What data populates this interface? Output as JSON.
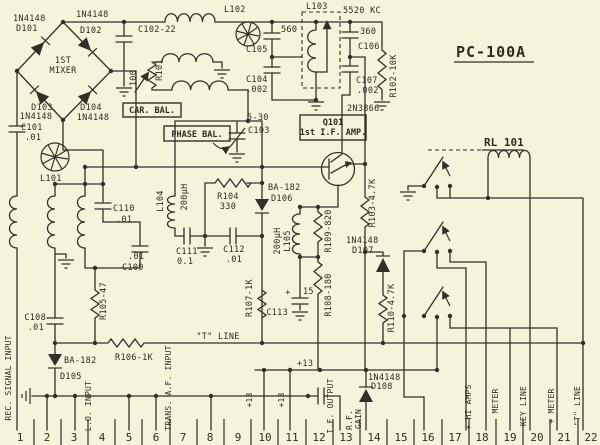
{
  "title": "PC-100A",
  "relay_name": "RL 101",
  "colors": {
    "background": "#f5f3da",
    "ink": "#33302a"
  },
  "boxes": {
    "car_bal": "CAR. BAL.",
    "phase_bal": "PHASE BAL.",
    "q101_line1": "Q101",
    "q101_line2": "1st I.F. AMP."
  },
  "labels": {
    "d101_pn": "1N4148",
    "d101": "D101",
    "d102_pn": "1N4148",
    "d102": "D102",
    "d103": "D103",
    "d103_pn": "1N4148",
    "d104": "D104",
    "d104_pn": "1N4148",
    "mixer1": "1ST",
    "mixer2": "MIXER",
    "c101": "C101",
    "c101_v": ".01",
    "l101": "L101",
    "l102": "L102",
    "l103": "L103",
    "c102": "C102-22",
    "r101": "R101",
    "r101_v": "100",
    "c103_v": "5-30",
    "c103": "C103",
    "c105_v": "560",
    "c105": "C105",
    "c104": "C104",
    "c104_v": ".002",
    "xtal": "5520 KC",
    "c106_v": "360",
    "c106": "C106",
    "c107": "C107",
    "c107_v": ".002",
    "r102": "R102-10K",
    "q101_pn": "2N3866",
    "c110": "C110",
    "c110_v": ".01",
    "c109": "C109",
    "c109_v": ".01",
    "l104": "L104",
    "l104_v": "200µH",
    "c111": "C111",
    "c111_v": "0.1",
    "c112": "C112",
    "c112_v": ".01",
    "r104": "R104",
    "r104_v": "330",
    "d106_pn": "BA-182",
    "d106": "D106",
    "l105": "L105",
    "l105_v": "200µH",
    "r109": "R109-820",
    "r103": "R103-4.7K",
    "d107_pn": "1N4148",
    "d107": "D107",
    "r110": "R110-4.7K",
    "r108": "R108-180",
    "r107": "R107-1K",
    "c113": "C113",
    "c113_plus": "+",
    "c113_v": "15",
    "t_line": "\"T\" LINE",
    "c108": "C108",
    "c108_v": ".01",
    "r105": "R105-47",
    "r106": "R106-1K",
    "d105_pn": "BA-182",
    "d105": "D105",
    "plus13": "+13",
    "d108_pn": "1N4148",
    "d108": "D108"
  },
  "pins": {
    "numbers": [
      "1",
      "2",
      "3",
      "4",
      "5",
      "6",
      "7",
      "8",
      "9",
      "10",
      "11",
      "12",
      "13",
      "14",
      "15",
      "16",
      "17",
      "18",
      "19",
      "20",
      "21",
      "22"
    ],
    "labels": {
      "rec": "REC. SIGNAL INPUT",
      "p4": "L.O. INPUT",
      "p7": "TRANS. A.F. INPUT",
      "p10": "+13",
      "p11": "+13",
      "p13": "I.F. OUTPUT",
      "p14a": "R.F.",
      "p14b": "GAIN",
      "p18": "+ HI AMPS",
      "p19": "- METER",
      "p20": "KEY LINE",
      "p21": "+ METER",
      "p22": "\"T\" LINE"
    }
  }
}
